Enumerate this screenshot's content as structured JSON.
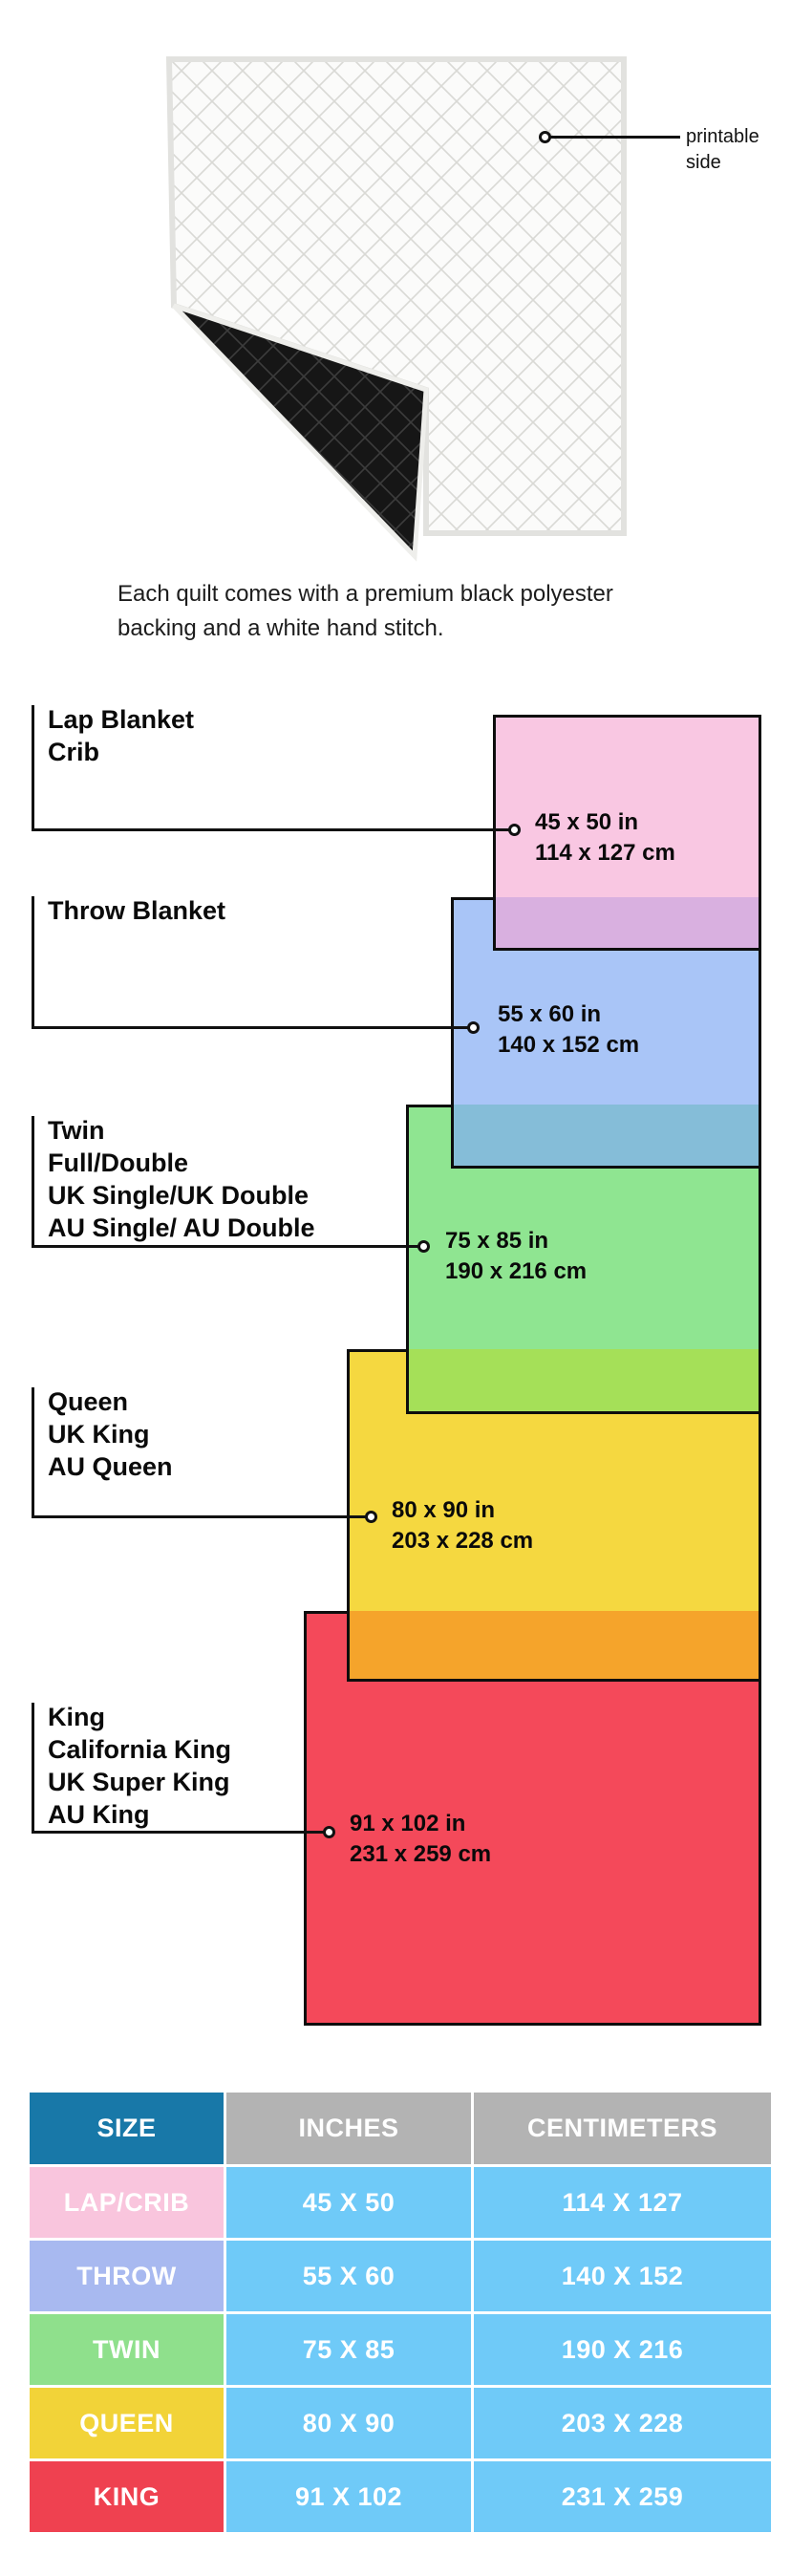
{
  "quilt": {
    "annotation_label": "printable side",
    "caption_line1": "Each quilt comes with a premium black polyester",
    "caption_line2": "backing and a white hand stitch."
  },
  "diagram": {
    "groups": [
      {
        "names": [
          "Lap Blanket",
          "Crib"
        ],
        "size_in": "45 x 50 in",
        "size_cm": "114 x 127 cm",
        "color": "#f9c7e2",
        "overlap_color": "#d9b0e0"
      },
      {
        "names": [
          "Throw Blanket"
        ],
        "size_in": "55 x 60 in",
        "size_cm": "140 x 152 cm",
        "color": "#a9c5f7",
        "overlap_color": "#85bdd8"
      },
      {
        "names": [
          "Twin",
          "Full/Double",
          "UK Single/UK Double",
          "AU Single/ AU Double"
        ],
        "size_in": "75 x 85 in",
        "size_cm": "190 x 216 cm",
        "color": "#8fe591",
        "overlap_color": "#a5e058"
      },
      {
        "names": [
          "Queen",
          "UK King",
          "AU Queen"
        ],
        "size_in": "80 x 90 in",
        "size_cm": "203 x 228 cm",
        "color": "#f5d840",
        "overlap_color": "#f5a42b"
      },
      {
        "names": [
          "King",
          "California King",
          "UK Super King",
          "AU King"
        ],
        "size_in": "91 x 102 in",
        "size_cm": "231 x 259 cm",
        "color": "#f4495a",
        "overlap_color": ""
      }
    ]
  },
  "table": {
    "headers": [
      "SIZE",
      "INCHES",
      "CENTIMETERS"
    ],
    "header_colors": {
      "size": "#1878a8",
      "other": "#b3b3b3"
    },
    "cell_color": "#6fcaf8",
    "rows": [
      {
        "size": "LAP/CRIB",
        "inches": "45 X 50",
        "cm": "114 X 127",
        "color": "#f9c5dd"
      },
      {
        "size": "THROW",
        "inches": "55 X 60",
        "cm": "140 X 152",
        "color": "#a8b9f0"
      },
      {
        "size": "TWIN",
        "inches": "75 X 85",
        "cm": "190 X 216",
        "color": "#8fe08c"
      },
      {
        "size": "QUEEN",
        "inches": "80 X 90",
        "cm": "203 X 228",
        "color": "#f2d338"
      },
      {
        "size": "KING",
        "inches": "91 X 102",
        "cm": "231 X 259",
        "color": "#ef4150"
      }
    ]
  }
}
